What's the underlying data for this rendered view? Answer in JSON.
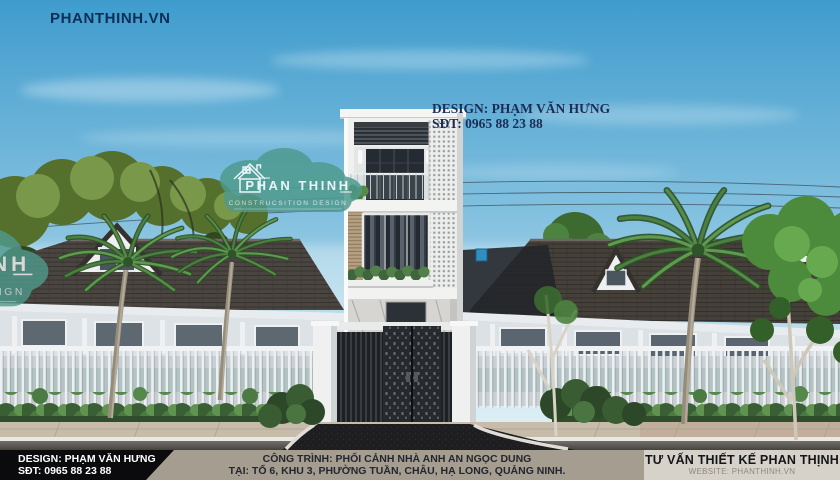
{
  "brand": {
    "url": "PHANTHINH.VN"
  },
  "credit": {
    "line1": "DESIGN: PHẠM VĂN HƯNG",
    "line2": "SĐT: 0965 88 23 88"
  },
  "watermark": {
    "name": "PHAN THINH",
    "subtitle": "CONSTRUCSITION DESIGN"
  },
  "footer": {
    "left": {
      "line1": "DESIGN: PHẠM VĂN HƯNG",
      "line2": "SĐT: 0965 88 23 88"
    },
    "center": {
      "line1": "CÔNG TRÌNH: PHỐI CẢNH NHÀ ANH AN NGỌC DUNG",
      "line2": "TẠI: TỔ 6, KHU 3, PHƯỜNG TUẦN, CHÂU, HẠ LONG, QUẢNG NINH."
    },
    "right": {
      "line1": "TƯ VẤN THIẾT KẾ PHAN THỊNH",
      "line2": "WEBSITE: PHANTHINH.VN"
    }
  },
  "colors": {
    "sky_top": "#47a0d2",
    "sky_horizon": "#d9edf4",
    "watermark_teal": "#4f9a8e",
    "accent_navy": "#1b2c55",
    "footer_left_bg": "#0b0b0d",
    "footer_center_bg": "#a59d90",
    "footer_right_bg": "#d6d2c9"
  }
}
